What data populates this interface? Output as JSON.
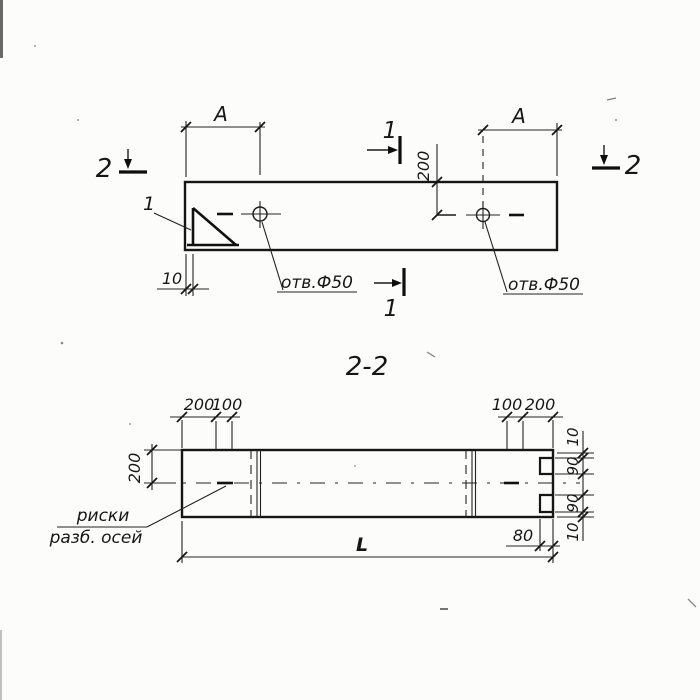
{
  "plan": {
    "dim_a_left": "A",
    "dim_a_right": "A",
    "dim_200": "200",
    "dim_10": "10",
    "hole_left_label": "отв.Ф50",
    "hole_right_label": "отв.Ф50",
    "callout_detail": "1",
    "section1_top": "1",
    "section1_bottom": "1",
    "section2_left": "2",
    "section2_right": "2"
  },
  "section": {
    "title": "2-2",
    "dim_left_200": "200",
    "dims_top_left": [
      "200",
      "100"
    ],
    "dims_top_right": [
      "100",
      "200"
    ],
    "dims_right": [
      "10",
      "90",
      "90",
      "10"
    ],
    "dim_80": "80",
    "dim_L": "L",
    "note": {
      "line1": "риски",
      "line2": "разб. осей"
    }
  },
  "colors": {
    "ink": "#161616",
    "paper": "#fcfcfa"
  }
}
